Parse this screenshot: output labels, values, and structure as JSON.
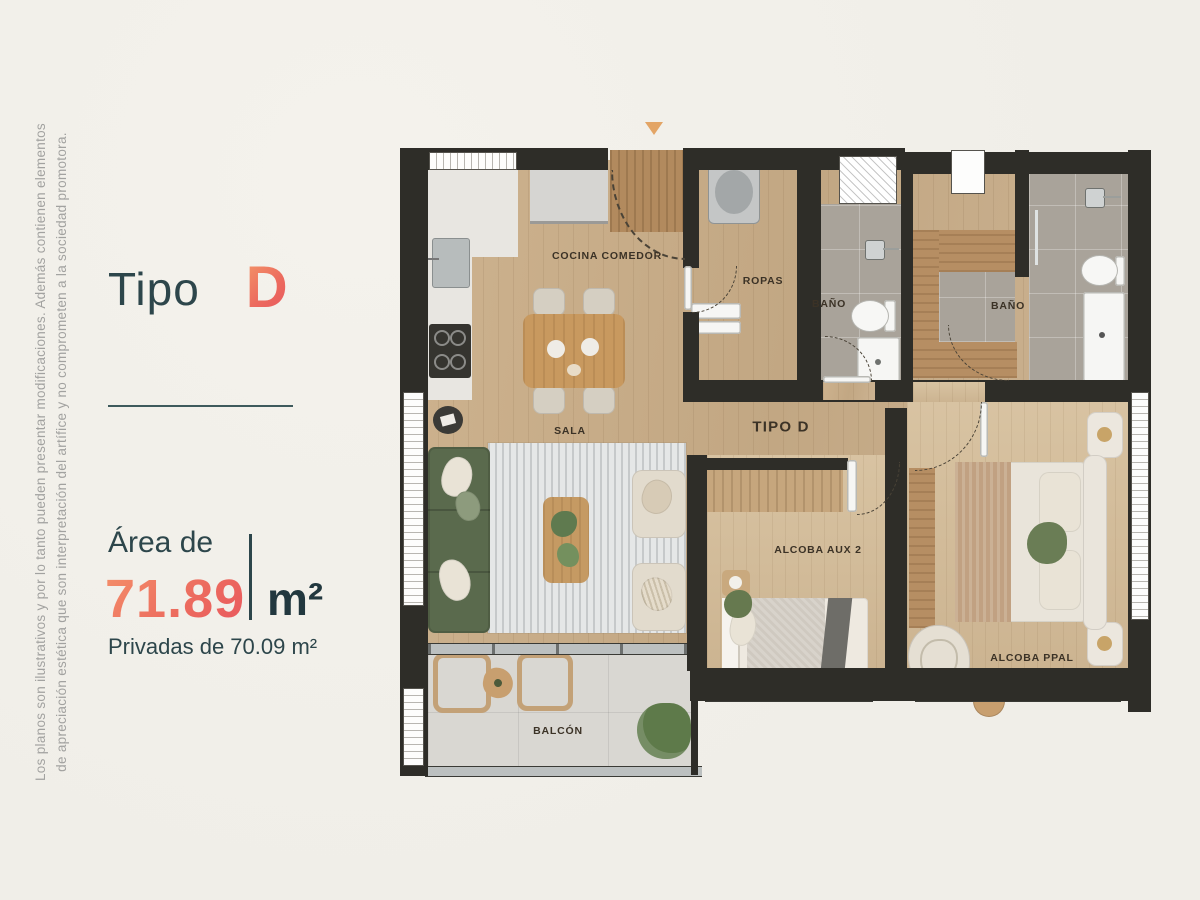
{
  "left_panel": {
    "title_prefix": "Tipo",
    "title_letter": "D",
    "area_label": "Área de",
    "area_value": "71.89",
    "area_unit": "m²",
    "private_area": "Privadas de 70.09 m²"
  },
  "disclaimer": {
    "line1": "Los planos son ilustrativos y por lo tanto pueden presentar modificaciones. Además contienen elementos",
    "line2": "de apreciación estética que son interpretación del artífice y no comprometen a la sociedad promotora."
  },
  "plan": {
    "label_cocina": "COCINA COMEDOR",
    "label_ropas": "ROPAS",
    "label_bano1": "BAÑO",
    "label_bano2": "BAÑO",
    "label_sala": "SALA",
    "label_hall": "TIPO D",
    "label_alcoba_aux": "ALCOBA AUX 2",
    "label_alcoba_ppal": "ALCOBA PPAL",
    "label_balcon": "BALCÓN"
  },
  "colors": {
    "accent_gradient_start": "#f49a6a",
    "accent_gradient_end": "#e75560",
    "ink_teal": "#2d464b",
    "wall": "#2e2d28",
    "wood_floor": "#c8ae8b",
    "bedroom_floor": "#d3bd9c",
    "bath_tile": "#a9a39a",
    "balcony_tile": "#d9d7d2",
    "sofa_green": "#5a6a4d",
    "entry_marker": "#e3a566",
    "background": "#f2f0ea"
  }
}
